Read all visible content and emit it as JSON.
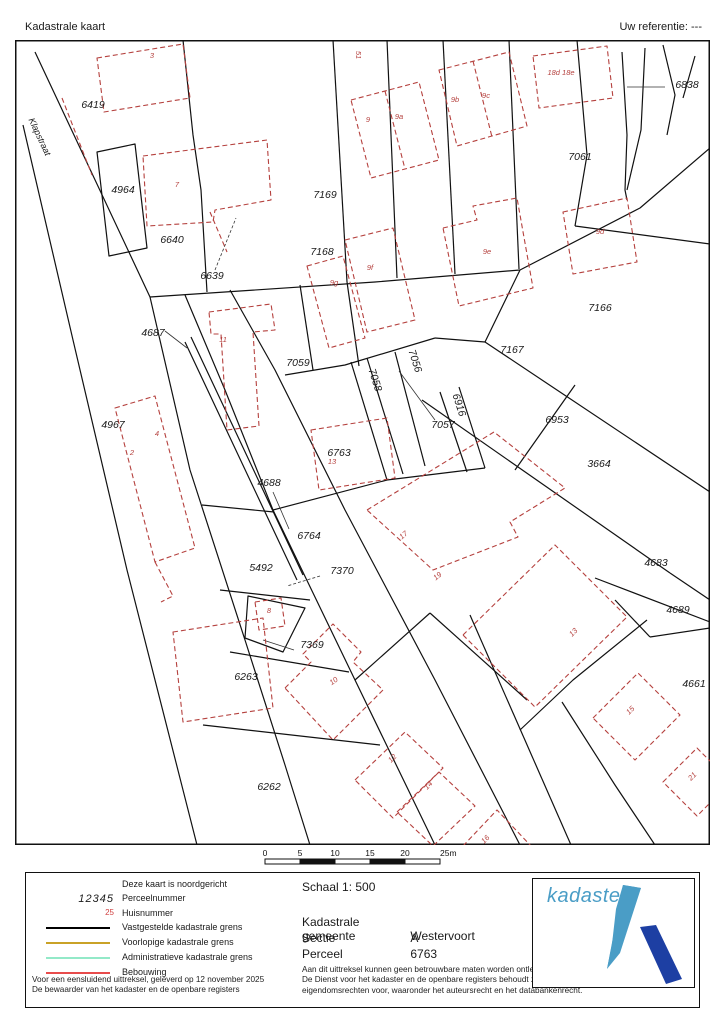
{
  "header": {
    "title": "Kadastrale kaart",
    "reference": "Uw referentie: ---"
  },
  "map": {
    "street_label": {
      "text": "Klapstraat",
      "x": 22,
      "y": 98,
      "r": 65
    },
    "parcel_labels": [
      {
        "t": "6419",
        "x": 78,
        "y": 68
      },
      {
        "t": "4964",
        "x": 108,
        "y": 153
      },
      {
        "t": "6640",
        "x": 157,
        "y": 203
      },
      {
        "t": "6639",
        "x": 197,
        "y": 239
      },
      {
        "t": "7169",
        "x": 310,
        "y": 158
      },
      {
        "t": "7168",
        "x": 307,
        "y": 215
      },
      {
        "t": "7061",
        "x": 565,
        "y": 120
      },
      {
        "t": "6838",
        "x": 672,
        "y": 48
      },
      {
        "t": "7166",
        "x": 585,
        "y": 271
      },
      {
        "t": "7167",
        "x": 497,
        "y": 313
      },
      {
        "t": "7059",
        "x": 283,
        "y": 326
      },
      {
        "t": "7056",
        "x": 397,
        "y": 322,
        "r": 72
      },
      {
        "t": "7058",
        "x": 357,
        "y": 341,
        "r": 72
      },
      {
        "t": "6916",
        "x": 441,
        "y": 366,
        "r": 72
      },
      {
        "t": "7057",
        "x": 428,
        "y": 388
      },
      {
        "t": "6953",
        "x": 542,
        "y": 383
      },
      {
        "t": "3664",
        "x": 584,
        "y": 427
      },
      {
        "t": "4687",
        "x": 138,
        "y": 296
      },
      {
        "t": "4967",
        "x": 98,
        "y": 388
      },
      {
        "t": "6763",
        "x": 324,
        "y": 416
      },
      {
        "t": "4688",
        "x": 254,
        "y": 446
      },
      {
        "t": "6764",
        "x": 294,
        "y": 499
      },
      {
        "t": "5492",
        "x": 246,
        "y": 531
      },
      {
        "t": "7370",
        "x": 327,
        "y": 534
      },
      {
        "t": "7369",
        "x": 297,
        "y": 608
      },
      {
        "t": "6263",
        "x": 231,
        "y": 640
      },
      {
        "t": "6262",
        "x": 254,
        "y": 750
      },
      {
        "t": "4683",
        "x": 641,
        "y": 526
      },
      {
        "t": "4689",
        "x": 663,
        "y": 573
      },
      {
        "t": "4661",
        "x": 679,
        "y": 647
      }
    ],
    "house_labels": [
      {
        "t": "3",
        "x": 137,
        "y": 18
      },
      {
        "t": "51",
        "x": 341,
        "y": 15,
        "r": 90
      },
      {
        "t": "9",
        "x": 353,
        "y": 82
      },
      {
        "t": "9a",
        "x": 384,
        "y": 79
      },
      {
        "t": "9b",
        "x": 440,
        "y": 62
      },
      {
        "t": "9c",
        "x": 471,
        "y": 58
      },
      {
        "t": "18d 18e",
        "x": 546,
        "y": 35
      },
      {
        "t": "7",
        "x": 162,
        "y": 147
      },
      {
        "t": "9d",
        "x": 585,
        "y": 194
      },
      {
        "t": "9e",
        "x": 472,
        "y": 214
      },
      {
        "t": "9f",
        "x": 355,
        "y": 230
      },
      {
        "t": "9g",
        "x": 319,
        "y": 245
      },
      {
        "t": "11",
        "x": 208,
        "y": 302
      },
      {
        "t": "4",
        "x": 142,
        "y": 396
      },
      {
        "t": "2",
        "x": 117,
        "y": 415
      },
      {
        "t": "13",
        "x": 317,
        "y": 424
      },
      {
        "t": "17",
        "x": 390,
        "y": 497,
        "r": -40
      },
      {
        "t": "19",
        "x": 424,
        "y": 538,
        "r": -40
      },
      {
        "t": "8",
        "x": 254,
        "y": 573
      },
      {
        "t": "10",
        "x": 320,
        "y": 643,
        "r": -35
      },
      {
        "t": "12",
        "x": 379,
        "y": 720,
        "r": -45
      },
      {
        "t": "14",
        "x": 415,
        "y": 747,
        "r": -45
      },
      {
        "t": "13",
        "x": 560,
        "y": 594,
        "r": -45
      },
      {
        "t": "15",
        "x": 617,
        "y": 672,
        "r": -45
      },
      {
        "t": "21",
        "x": 679,
        "y": 738,
        "r": -45
      },
      {
        "t": "16",
        "x": 472,
        "y": 801,
        "r": -45
      }
    ],
    "scale_bar": {
      "ticks": [
        "0",
        "5",
        "10",
        "15",
        "20",
        "25m"
      ]
    }
  },
  "legend": {
    "north_note": "Deze kaart is noordgericht",
    "items": [
      {
        "symbol": "12345",
        "label": "Perceelnummer"
      },
      {
        "symbol": "25",
        "label": "Huisnummer"
      },
      {
        "label": "Vastgestelde kadastrale grens",
        "color": "#000000"
      },
      {
        "label": "Voorlopige kadastrale grens",
        "color": "#c9a227"
      },
      {
        "label": "Administratieve kadastrale grens",
        "color": "#93e9c8"
      },
      {
        "label": "Bebouwing",
        "color": "#e84c4c"
      }
    ]
  },
  "info": {
    "schaal": "Schaal 1: 500",
    "rows": [
      {
        "label": "Kadastrale gemeente",
        "value": "Westervoort"
      },
      {
        "label": "Sectie",
        "value": "A"
      },
      {
        "label": "Perceel",
        "value": "6763"
      }
    ]
  },
  "disclaimers": {
    "left": [
      "Voor een eensluidend uittreksel, geleverd op 12 november 2025",
      "De bewaarder van het kadaster en de openbare registers"
    ],
    "right": [
      "Aan dit uittreksel kunnen geen betrouwbare maten worden ontleend.",
      "De Dienst voor het kadaster en de openbare registers behoudt zich de intellectuele",
      "eigendomsrechten voor, waaronder het auteursrecht en het databankenrecht."
    ]
  },
  "logo": {
    "wordmark": "kadaster",
    "light_blue": "#4a9dc6",
    "dark_blue": "#1d3fa3"
  },
  "colors": {
    "boundary": "#1a1a1a",
    "building": "#b5413e"
  }
}
